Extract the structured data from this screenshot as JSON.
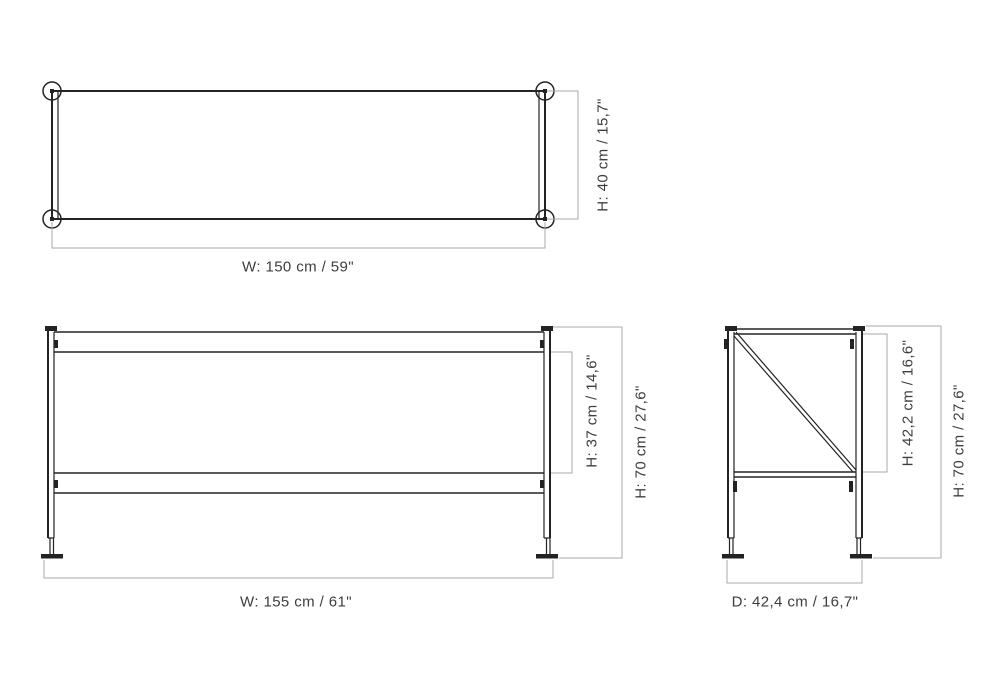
{
  "colors": {
    "line": "#232323",
    "dimension": "#a7a9ac",
    "text": "#3e3e3e",
    "background": "#ffffff"
  },
  "views": {
    "top": {
      "dimensions": {
        "width": "W: 150 cm / 59\"",
        "depth": "H: 40 cm / 15,7\""
      }
    },
    "front": {
      "dimensions": {
        "width": "W: 155 cm / 61\"",
        "shelf_clearance": "H: 37 cm / 14,6\"",
        "total_height": "H: 70 cm / 27,6\""
      }
    },
    "side": {
      "dimensions": {
        "depth": "D: 42,4 cm / 16,7\"",
        "frame_height": "H: 42,2 cm / 16,6\"",
        "total_height": "H: 70 cm / 27,6\""
      }
    }
  }
}
